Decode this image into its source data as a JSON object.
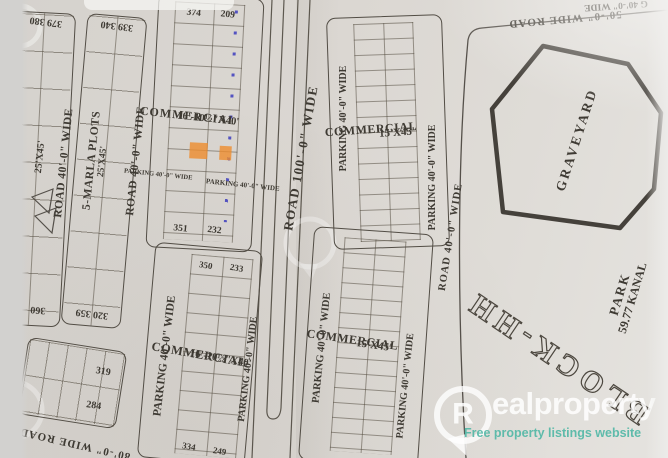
{
  "labels": {
    "road_40": "ROAD 40'-0\" WIDE",
    "road_100": "ROAD 100'-0\" WIDE",
    "road_50_top": "50'-0\" WIDE ROAD",
    "road_80_bottom": "80'-0\" WIDE ROAD",
    "parking_40": "PARKING 40'-0\" WIDE",
    "parking_40_fragment": "G 40'-0\" WIDE",
    "commercial": "COMMERCIAL",
    "size_16": "16'-10½\"X40'",
    "size_15": "15'X45'",
    "size_25": "25'X45'",
    "marla": "5-MARLA PLOTS",
    "graveyard": "GRAVEYARD",
    "park": "PARK",
    "park_area": "59.77 KANAL",
    "block_name": "BLOCK-HH"
  },
  "plot_numbers": {
    "strip_a_top": "379 380",
    "strip_a_bottom": "360",
    "strip_c_top": "339 340",
    "strip_c_bottom": "320 359",
    "block_e_top_left": "374",
    "block_e_top_right": "209",
    "block_e_bottom_left": "351",
    "block_e_bottom_right": "232",
    "block_o_top_left": "350",
    "block_o_top_right": "233",
    "block_o_bottom_left": "334",
    "block_o_bottom_right": "249",
    "block_m_top": "319",
    "block_m_bottom": "284"
  },
  "watermark": {
    "logo_letter": "R",
    "brand_rest": "ealproperty",
    "tagline": "Free property listings website",
    "accent_color": "#52b7a6"
  }
}
